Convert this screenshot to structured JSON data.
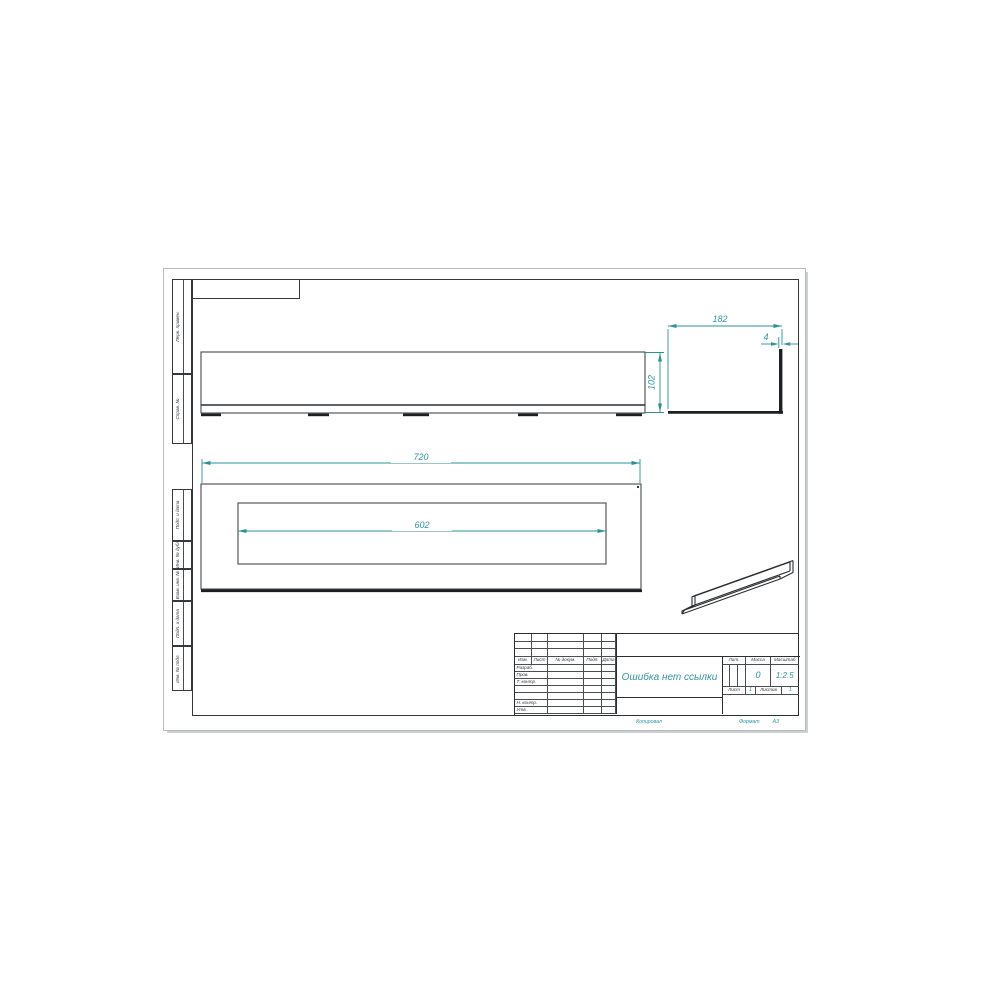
{
  "sheet": {
    "copied_label": "Копировал",
    "format_label": "Формат",
    "format_value": "А3",
    "side_labels": {
      "top": [
        "Перв. примен.",
        "Справ. №"
      ],
      "bottom": [
        "Подп. и дата",
        "Инв. № дубл.",
        "Взам. инв. №",
        "Подп. и дата",
        "Инв. № подл."
      ]
    }
  },
  "views": {
    "front_view_length_dim": "720",
    "opening_length_dim": "602",
    "front_view_height_dim": "102",
    "section_width_dim": "182",
    "flange_thickness_dim": "4"
  },
  "title_block": {
    "doc_name": "Ошибка нет ссылки",
    "columns": [
      "Изм.",
      "Лист",
      "№ докум.",
      "Подп.",
      "Дата"
    ],
    "signature_rows": [
      "Разраб.",
      "Пров.",
      "Т. контр.",
      "Н. контр.",
      "Утв."
    ],
    "lit_label": "Лит.",
    "mass_label": "Масса",
    "scale_label": "Масштаб",
    "mass_value": "0",
    "scale_value": "1:2.5",
    "sheet_label": "Лист",
    "sheet_value": "1",
    "sheets_label": "Листов",
    "sheets_value": "1"
  },
  "colors": {
    "accent_teal": "#2e96a0",
    "line_dark": "#2b2e30"
  }
}
